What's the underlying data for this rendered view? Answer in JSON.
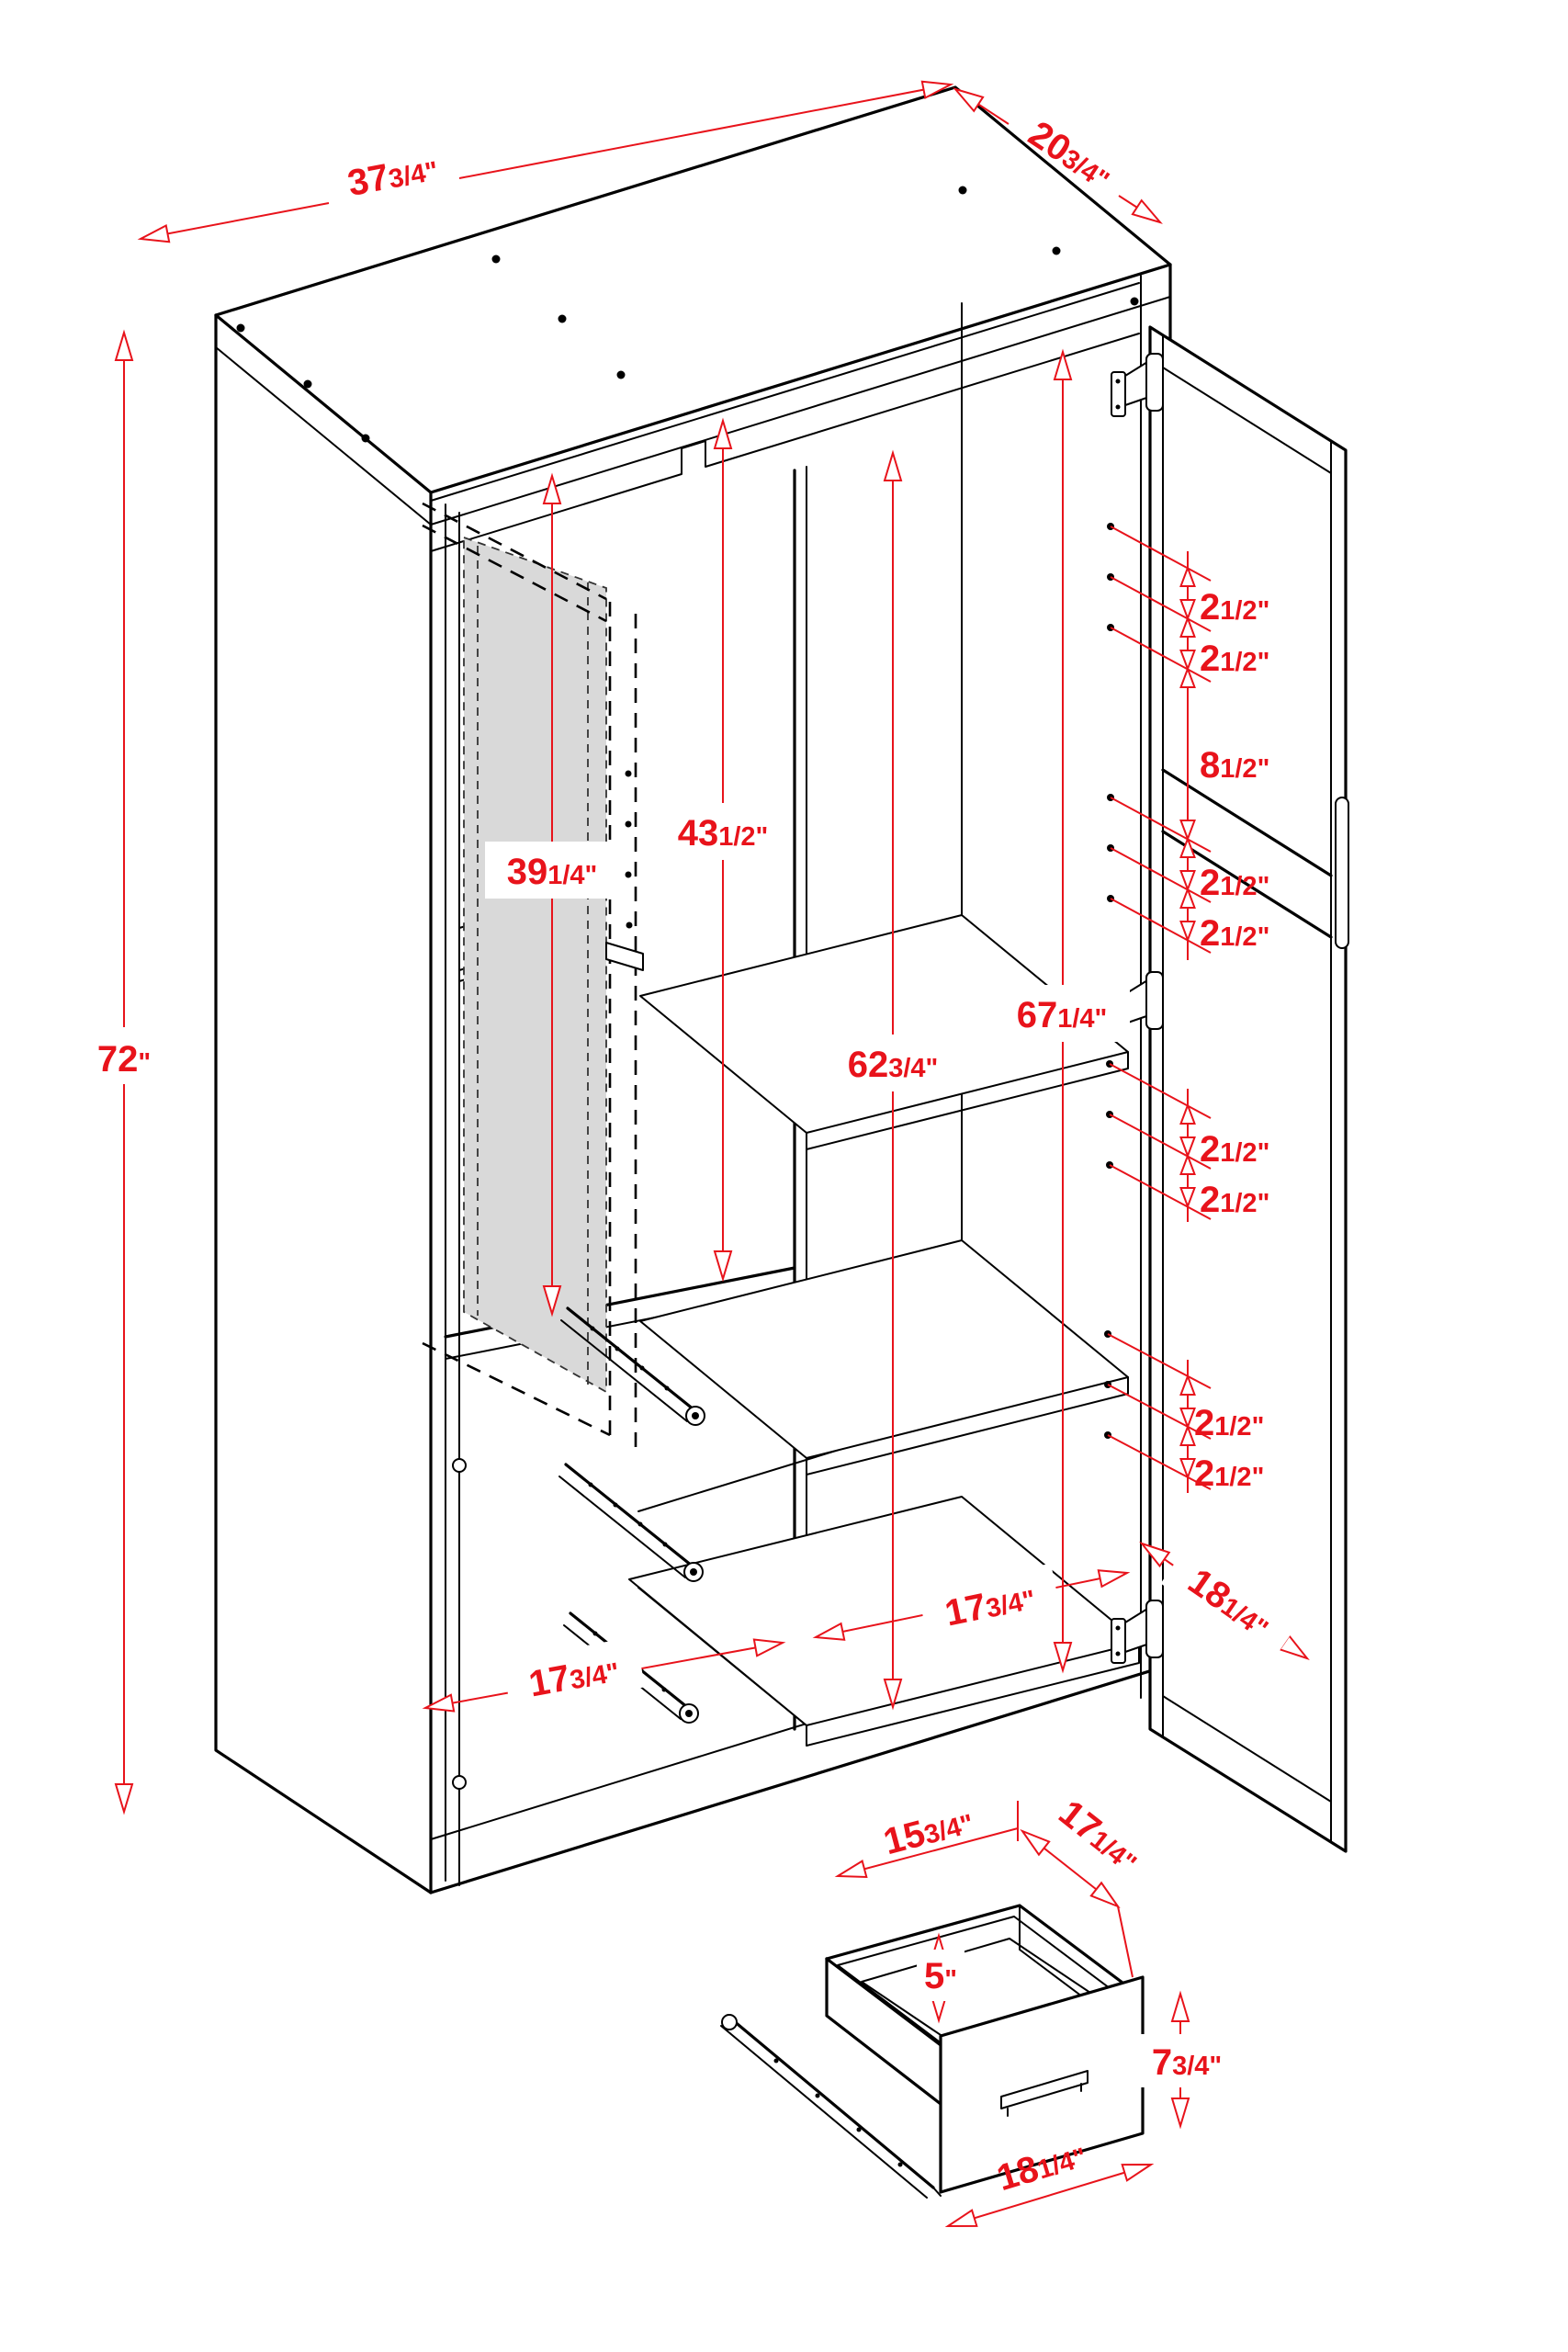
{
  "title": "Wardrobe armoire dimension diagram",
  "colors": {
    "dimension_red": "#e8131b",
    "line_black": "#000000",
    "mirror_gray": "#d9d9d9",
    "background": "#ffffff"
  },
  "dims": {
    "cabinet_width": {
      "whole": "37",
      "frac": "3/4\""
    },
    "cabinet_depth": {
      "whole": "20",
      "frac": "3/4\""
    },
    "cabinet_height": {
      "whole": "72",
      "frac": "\""
    },
    "mirror_door_height": {
      "whole": "39",
      "frac": "1/4\""
    },
    "left_interior_height": {
      "whole": "43",
      "frac": "1/2\""
    },
    "shelf_interior_height": {
      "whole": "62",
      "frac": "3/4\""
    },
    "right_interior_height": {
      "whole": "67",
      "frac": "1/4\""
    },
    "hole_spacing": {
      "whole": "2",
      "frac": "1/2\""
    },
    "hinge_rail_gap": {
      "whole": "8",
      "frac": "1/2\""
    },
    "left_interior_width": {
      "whole": "17",
      "frac": "3/4\""
    },
    "right_interior_width": {
      "whole": "17",
      "frac": "3/4\""
    },
    "door_width": {
      "whole": "18",
      "frac": "1/4\""
    },
    "drawer_interior_width": {
      "whole": "15",
      "frac": "3/4\""
    },
    "drawer_depth": {
      "whole": "17",
      "frac": "1/4\""
    },
    "drawer_interior_height": {
      "whole": "5",
      "frac": "\""
    },
    "drawer_front_height": {
      "whole": "7",
      "frac": "3/4\""
    },
    "drawer_width": {
      "whole": "18",
      "frac": "1/4\""
    }
  }
}
